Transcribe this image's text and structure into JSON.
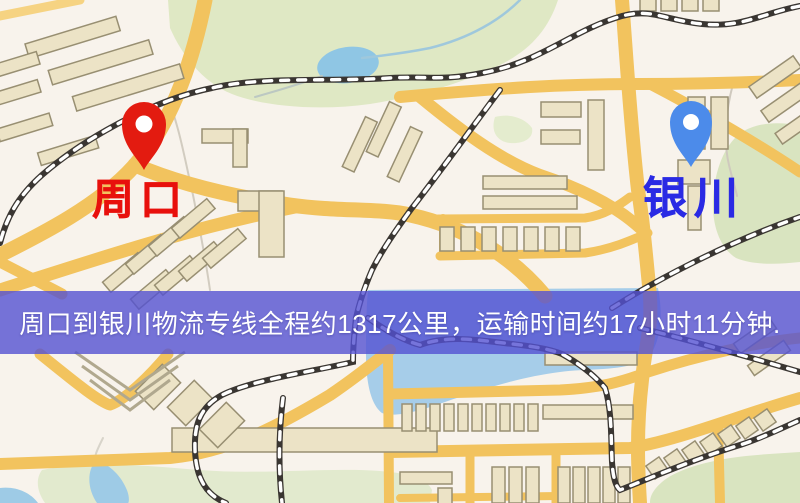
{
  "cities": {
    "origin": {
      "name": "周口",
      "pin_icon": "red-pin",
      "pin_color": "#e31b10",
      "label_color": "#e8100c"
    },
    "destination": {
      "name": "银川",
      "pin_icon": "blue-pin",
      "pin_color": "#4c8bea",
      "label_color": "#2a2ae4"
    }
  },
  "banner": {
    "text": "周口到银川物流专线全程约1317公里，运输时间约17小时11分钟.",
    "bg_color": "#5451d2",
    "text_color": "#ffffff",
    "route": {
      "from": "周口",
      "to": "银川",
      "distance_km": 1317,
      "duration_hours": 17,
      "duration_minutes": 11
    }
  },
  "map_colors": {
    "background": "#f8f3ec",
    "road": "#f2c35e",
    "road_minor": "#f6d382",
    "building_fill": "#ece3c6",
    "building_stroke": "#988f72",
    "park": "#dfe8c4",
    "water": "#9ecbe6",
    "railway": "#3a3632"
  }
}
